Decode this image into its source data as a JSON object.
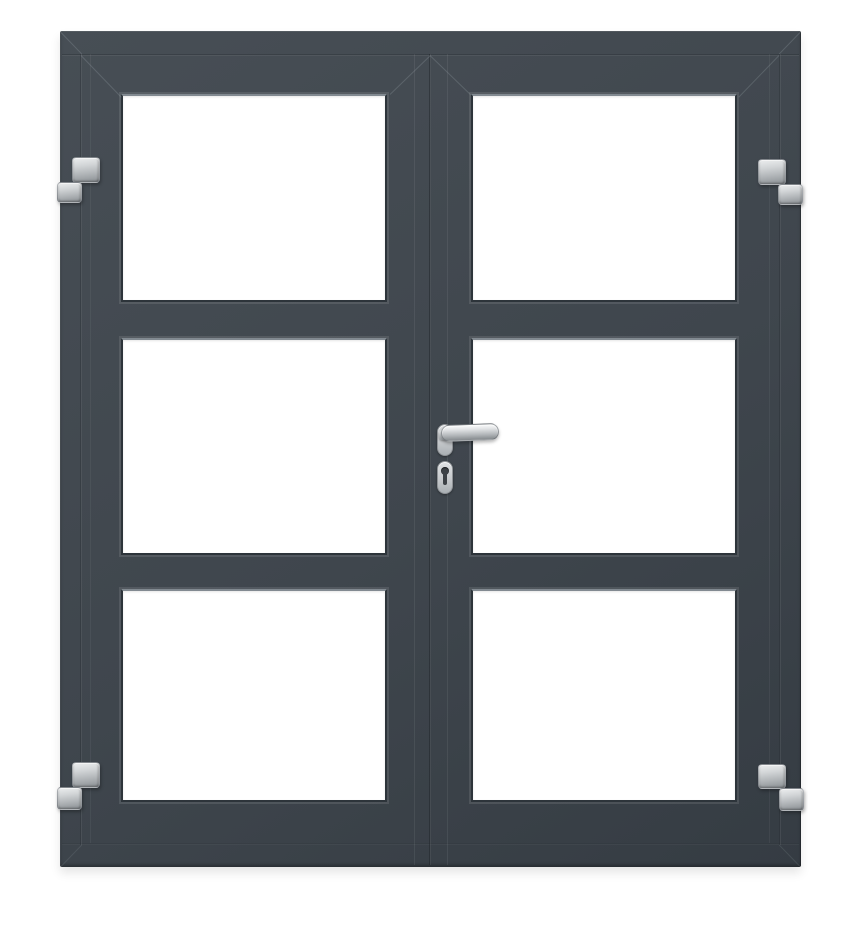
{
  "scene": {
    "description": "Anthracite grey double door with three clear glass panels per leaf, four stainless steel hinges and a central stainless lever handle with euro cylinder lock",
    "leaf_count": 2,
    "panes_per_leaf": 3,
    "hinge_count": 4
  },
  "parts": {
    "door": "Double glazed door",
    "frame": "Outer door frame",
    "left_leaf": "Left door leaf",
    "right_leaf": "Right door leaf",
    "glass_pane": "Glass panel",
    "transom_bar": "Horizontal glazing bar",
    "hinge": "Stainless steel hinge",
    "handle": "Stainless steel lever handle",
    "rosette": "Handle rosette",
    "lock": "Lock escutcheon",
    "keyhole": "Euro profile cylinder keyhole"
  },
  "colors": {
    "background": "#ffffff",
    "door_base": "#3f464d",
    "door_light": "#474e55",
    "door_dark": "#353c43",
    "glass": "#ffffff",
    "bead_highlight": "#828a91",
    "pane_edge": "#2d343a",
    "metal_light": "#eceeef",
    "metal_mid": "#b1b5b8",
    "metal_dark": "#8a8f93"
  }
}
